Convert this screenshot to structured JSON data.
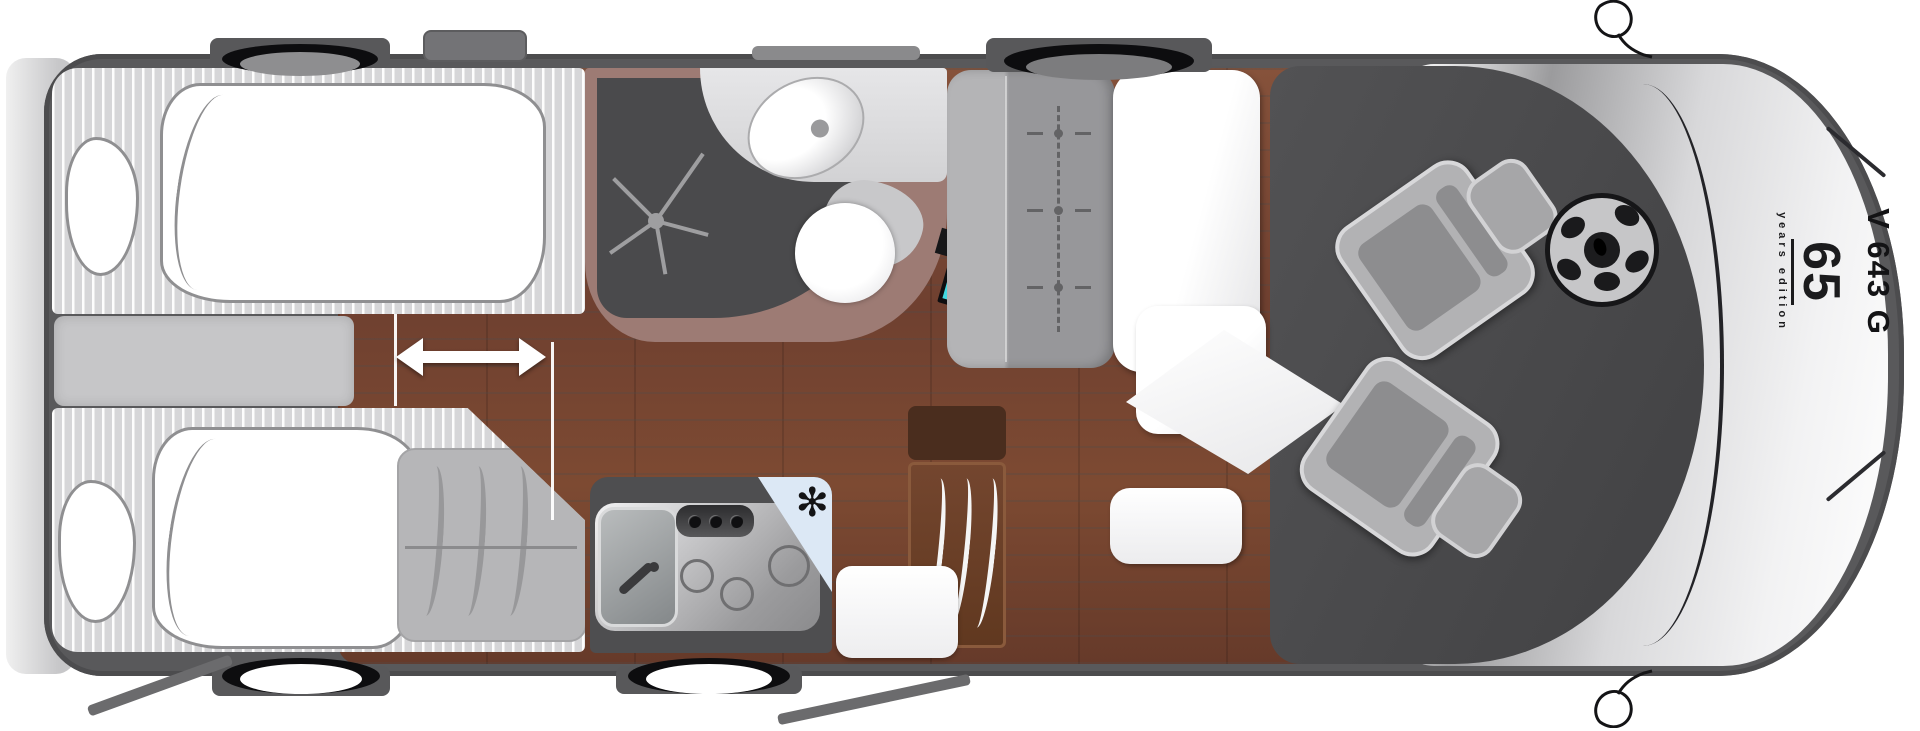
{
  "labels": {
    "tv": "TV",
    "edition_number": "65",
    "edition_caption": "years edition",
    "model_code": "V 643 G"
  },
  "icons": {
    "snowflake_glyph": "✻"
  },
  "colors": {
    "tv_accent_cyan": "#41d8e0",
    "fridge_blue": "#dce8f5",
    "wood_floor": "#7b4733",
    "bath_wall": "#9d7b74",
    "body_wall": "#59595b",
    "cab_mat": "#4a4a4c"
  }
}
